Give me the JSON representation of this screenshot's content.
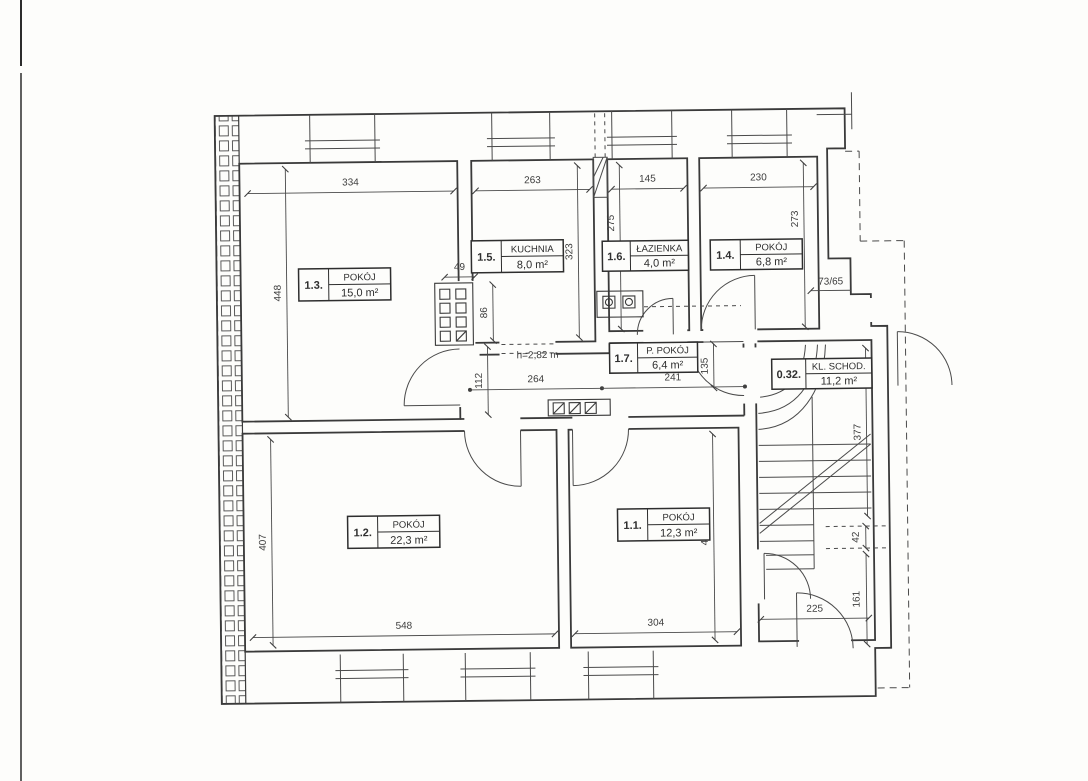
{
  "sheet": {
    "type": "scanned architectural floor plan",
    "paper_color": "#fdfdfb",
    "line_color": "#3a3a3a"
  },
  "rooms": [
    {
      "id": "1.3.",
      "name": "POKÓJ",
      "area": "15,0 m²"
    },
    {
      "id": "1.5.",
      "name": "KUCHNIA",
      "area": "8,0 m²"
    },
    {
      "id": "1.6.",
      "name": "ŁAZIENKA",
      "area": "4,0 m²"
    },
    {
      "id": "1.4.",
      "name": "POKÓJ",
      "area": "6,8 m²"
    },
    {
      "id": "1.7.",
      "name": "P. POKÓJ",
      "area": "6,4 m²"
    },
    {
      "id": "0.32.",
      "name": "KL. SCHOD.",
      "area": "11,2 m²"
    },
    {
      "id": "1.2.",
      "name": "POKÓJ",
      "area": "22,3 m²"
    },
    {
      "id": "1.1.",
      "name": "POKÓJ",
      "area": "12,3 m²"
    }
  ],
  "dimensions": {
    "top_334": "334",
    "top_263": "263",
    "top_145": "145",
    "top_230": "230",
    "left_448": "448",
    "left_407": "407",
    "v_323": "323",
    "v_275": "275",
    "v_273": "273",
    "v_86": "86",
    "v_112": "112",
    "v_135": "135",
    "v_377": "377",
    "v_42": "42",
    "v_161": "161",
    "v_405": "405",
    "h_264": "264",
    "h_241": "241",
    "h_548": "548",
    "h_304": "304",
    "h_225": "225",
    "h_49": "49",
    "door_73_65": "73/65",
    "height_note": "h=2,82 m"
  }
}
